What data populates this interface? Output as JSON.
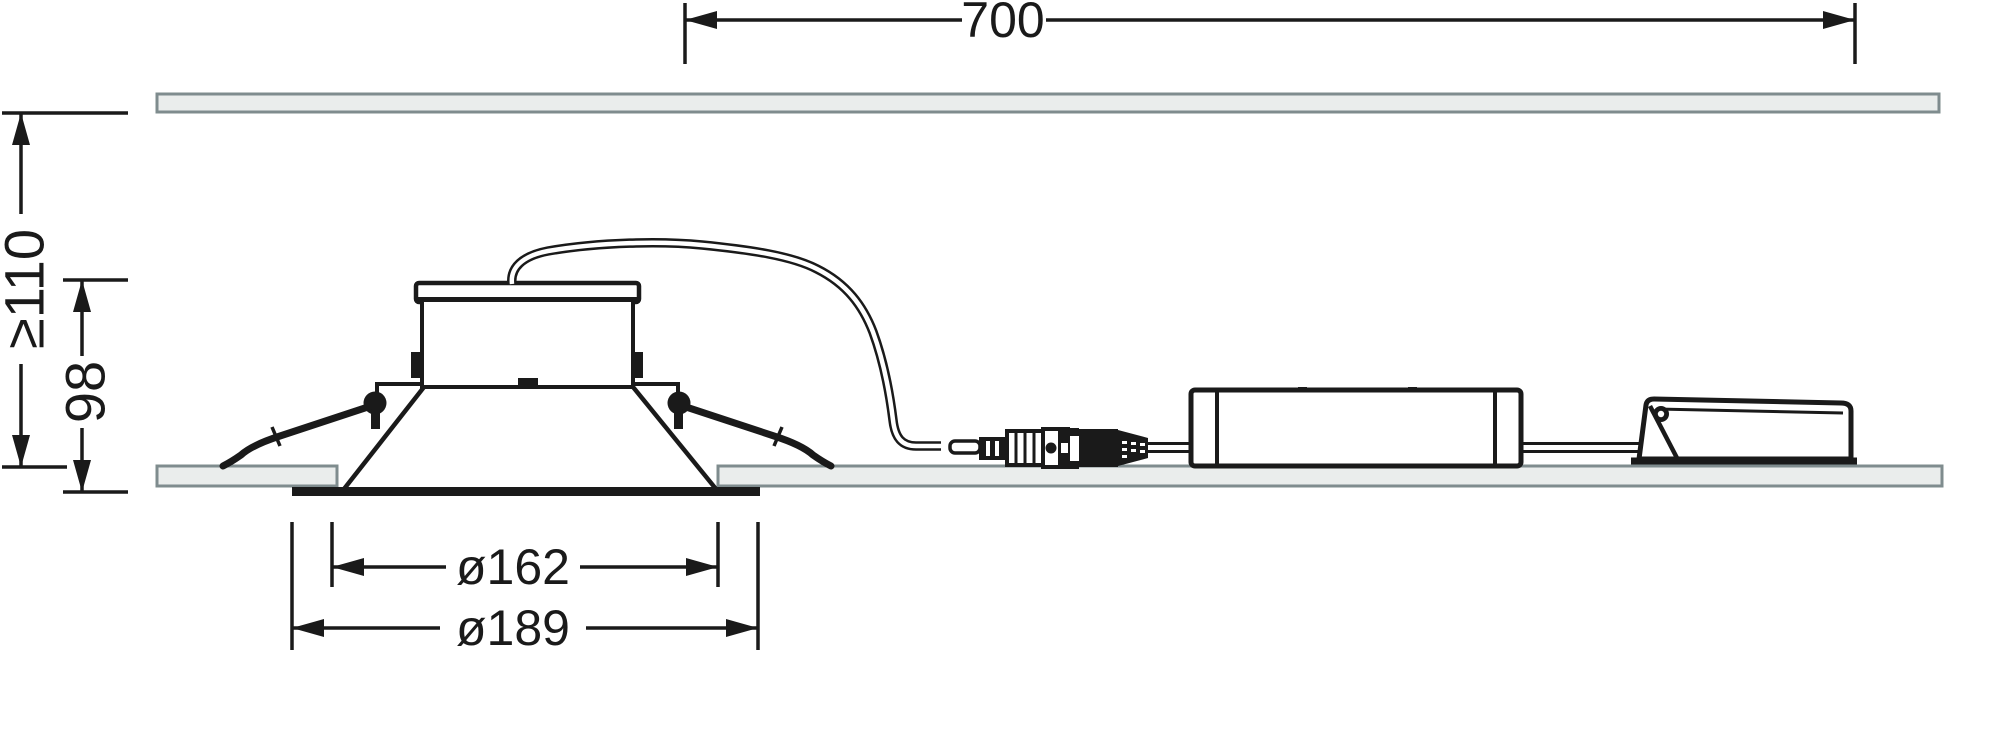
{
  "dimensions": {
    "cable_run": {
      "label": "700"
    },
    "min_recess_depth": {
      "label": "≥110"
    },
    "fixture_height": {
      "label": "98"
    },
    "cutout_diameter": {
      "label": "ø162"
    },
    "outer_diameter": {
      "label": "ø189"
    }
  },
  "colors": {
    "line": "#1a1a1a",
    "ceiling_fill": "#eaedec",
    "ceiling_border": "#7f8c8e"
  }
}
